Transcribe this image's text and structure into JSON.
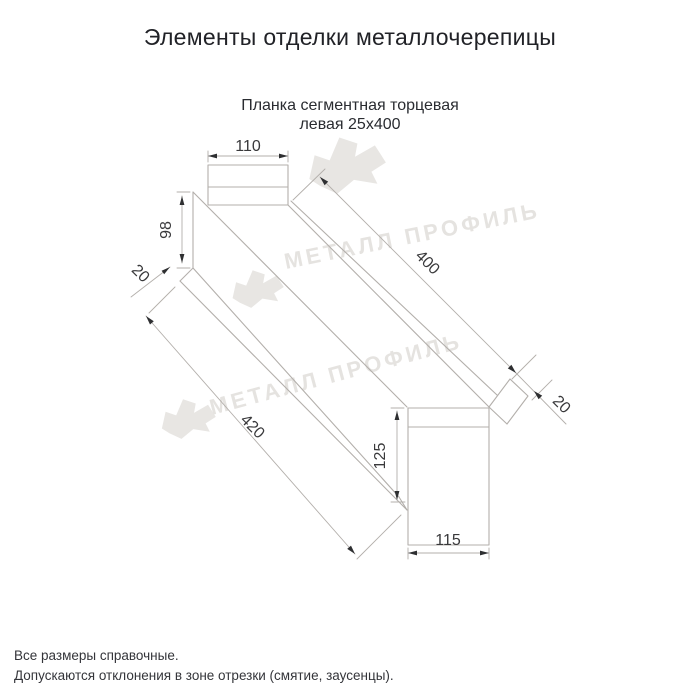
{
  "title": "Элементы отделки металлочерепицы",
  "product": {
    "name_line1": "Планка сегментная торцевая",
    "name_line2": "левая 25х400"
  },
  "drawing": {
    "dimensions": {
      "top_flange_width": "110",
      "side_height": "98",
      "side_hem": "20",
      "length_top": "400",
      "end_tab": "20",
      "length_bottom": "420",
      "end_height": "125",
      "end_width": "115"
    },
    "line_color": "#b3afab",
    "label_color": "#39393b"
  },
  "watermark": {
    "brand": "МЕТАЛЛ ПРОФИЛЬ",
    "color": "#e5e3e0"
  },
  "notes": {
    "line1": "Все размеры справочные.",
    "line2": "Допускаются отклонения в зоне отрезки (смятие, заусенцы)."
  }
}
